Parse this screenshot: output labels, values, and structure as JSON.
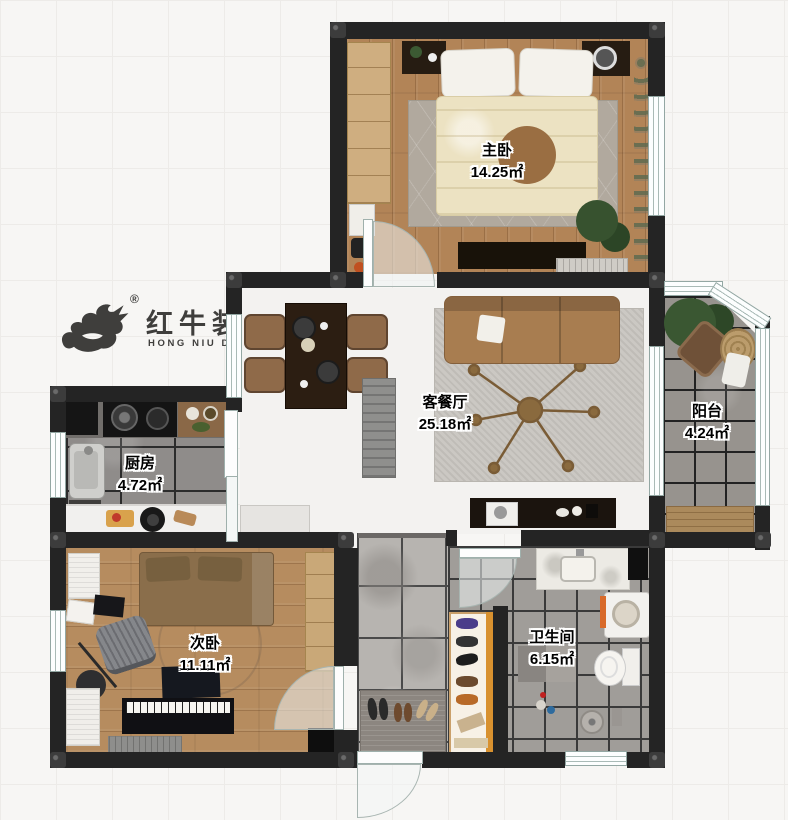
{
  "logo": {
    "brand_cn": "红牛装饰",
    "brand_en": "HONG NIU DECORATION",
    "registered": "®"
  },
  "rooms": [
    {
      "id": "master-bedroom",
      "name": "主卧",
      "area": "14.25㎡"
    },
    {
      "id": "living-dining-room",
      "name": "客餐厅",
      "area": "25.18㎡"
    },
    {
      "id": "balcony",
      "name": "阳台",
      "area": "4.24㎡"
    },
    {
      "id": "kitchen",
      "name": "厨房",
      "area": "4.72㎡"
    },
    {
      "id": "second-bedroom",
      "name": "次卧",
      "area": "11.11㎡"
    },
    {
      "id": "bathroom",
      "name": "卫生间",
      "area": "6.15㎡"
    }
  ],
  "colors": {
    "wall": "#242424",
    "window_frame": "#9fb0ac",
    "wood_floor": "#b28457",
    "label_text": "#000000",
    "background": "#f7f6f4"
  }
}
